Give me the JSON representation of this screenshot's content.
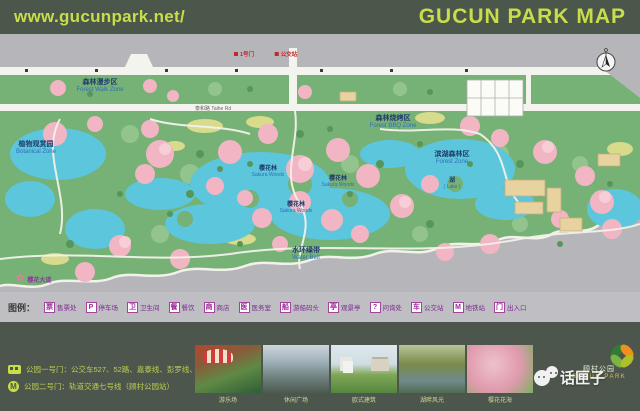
{
  "header": {
    "url": "www.gucunpark.net/",
    "title": "GUCUN PARK MAP"
  },
  "map": {
    "road_label": {
      "text": "泰和路 Taihe Rd"
    },
    "sakura": {
      "label": "樱花大道"
    },
    "zones": [
      {
        "zh": "森林漫步区",
        "en": "Forest Walk Zone",
        "x": 100,
        "y": 52
      },
      {
        "zh": "森林烧烤区",
        "en": "Forest BBQ Zone",
        "x": 393,
        "y": 88
      },
      {
        "zh": "植物观赏园",
        "en": "Botanical Zone",
        "x": 36,
        "y": 114
      },
      {
        "zh": "樱花林",
        "en": "Sakura Woods",
        "x": 268,
        "y": 138,
        "small": true
      },
      {
        "zh": "樱花林",
        "en": "Sakura Woods",
        "x": 338,
        "y": 148,
        "small": true
      },
      {
        "zh": "樱花林",
        "en": "Sakura Woods",
        "x": 296,
        "y": 174,
        "small": true
      },
      {
        "zh": "滨湖森林区",
        "en": "Forest Zone",
        "x": 452,
        "y": 124
      },
      {
        "zh": "湖",
        "en": "( Lake )",
        "x": 452,
        "y": 150,
        "small": true
      },
      {
        "zh": "水环绿带",
        "en": "Water Belt",
        "x": 306,
        "y": 220
      }
    ],
    "markers": [
      {
        "text": "1号门",
        "x": 244,
        "y": 16
      },
      {
        "text": "公交站",
        "x": 286,
        "y": 16
      }
    ],
    "compass": "north-compass"
  },
  "legend": {
    "title": "图例：",
    "items": [
      {
        "icon": "票",
        "label": "售票处"
      },
      {
        "icon": "P",
        "label": "停车场"
      },
      {
        "icon": "卫",
        "label": "卫生间"
      },
      {
        "icon": "餐",
        "label": "餐饮"
      },
      {
        "icon": "商",
        "label": "商店"
      },
      {
        "icon": "医",
        "label": "医务室"
      },
      {
        "icon": "船",
        "label": "游船码头"
      },
      {
        "icon": "亭",
        "label": "观景亭"
      },
      {
        "icon": "?",
        "label": "问询处"
      },
      {
        "icon": "车",
        "label": "公交站"
      },
      {
        "icon": "M",
        "label": "地铁站"
      },
      {
        "icon": "门",
        "label": "出入口"
      }
    ]
  },
  "transit": [
    {
      "icon": "bus",
      "text": "公园一号门：公交车527、52路、嘉泰线、彭罗线、北嘉线"
    },
    {
      "icon": "metro",
      "text": "公园二号门：轨道交通七号线（顾村公园站）"
    }
  ],
  "photos": [
    {
      "caption": "游乐场",
      "cls": "ph1",
      "decor": "carousel"
    },
    {
      "caption": "休闲广场",
      "cls": "ph2",
      "decor": ""
    },
    {
      "caption": "欧式建筑",
      "cls": "ph3",
      "decor": "pavilion chateau"
    },
    {
      "caption": "湖畔风光",
      "cls": "ph4",
      "decor": ""
    },
    {
      "caption": "樱花花海",
      "cls": "ph5",
      "decor": ""
    }
  ],
  "brand": {
    "park_zh": "顾村公园",
    "park_en": "GUCUN PARK",
    "watermark": "话匣子"
  },
  "colors": {
    "header_bg": "#4a574a",
    "accent_text": "#c9dd4b",
    "park_green": "#76b175",
    "water": "#5cc6dc",
    "blossom_pink": "#f1b5c3",
    "map_gray": "#b6b6ba",
    "footer_bg": "#4c564c",
    "legend_purple": "#7a2a8e"
  }
}
